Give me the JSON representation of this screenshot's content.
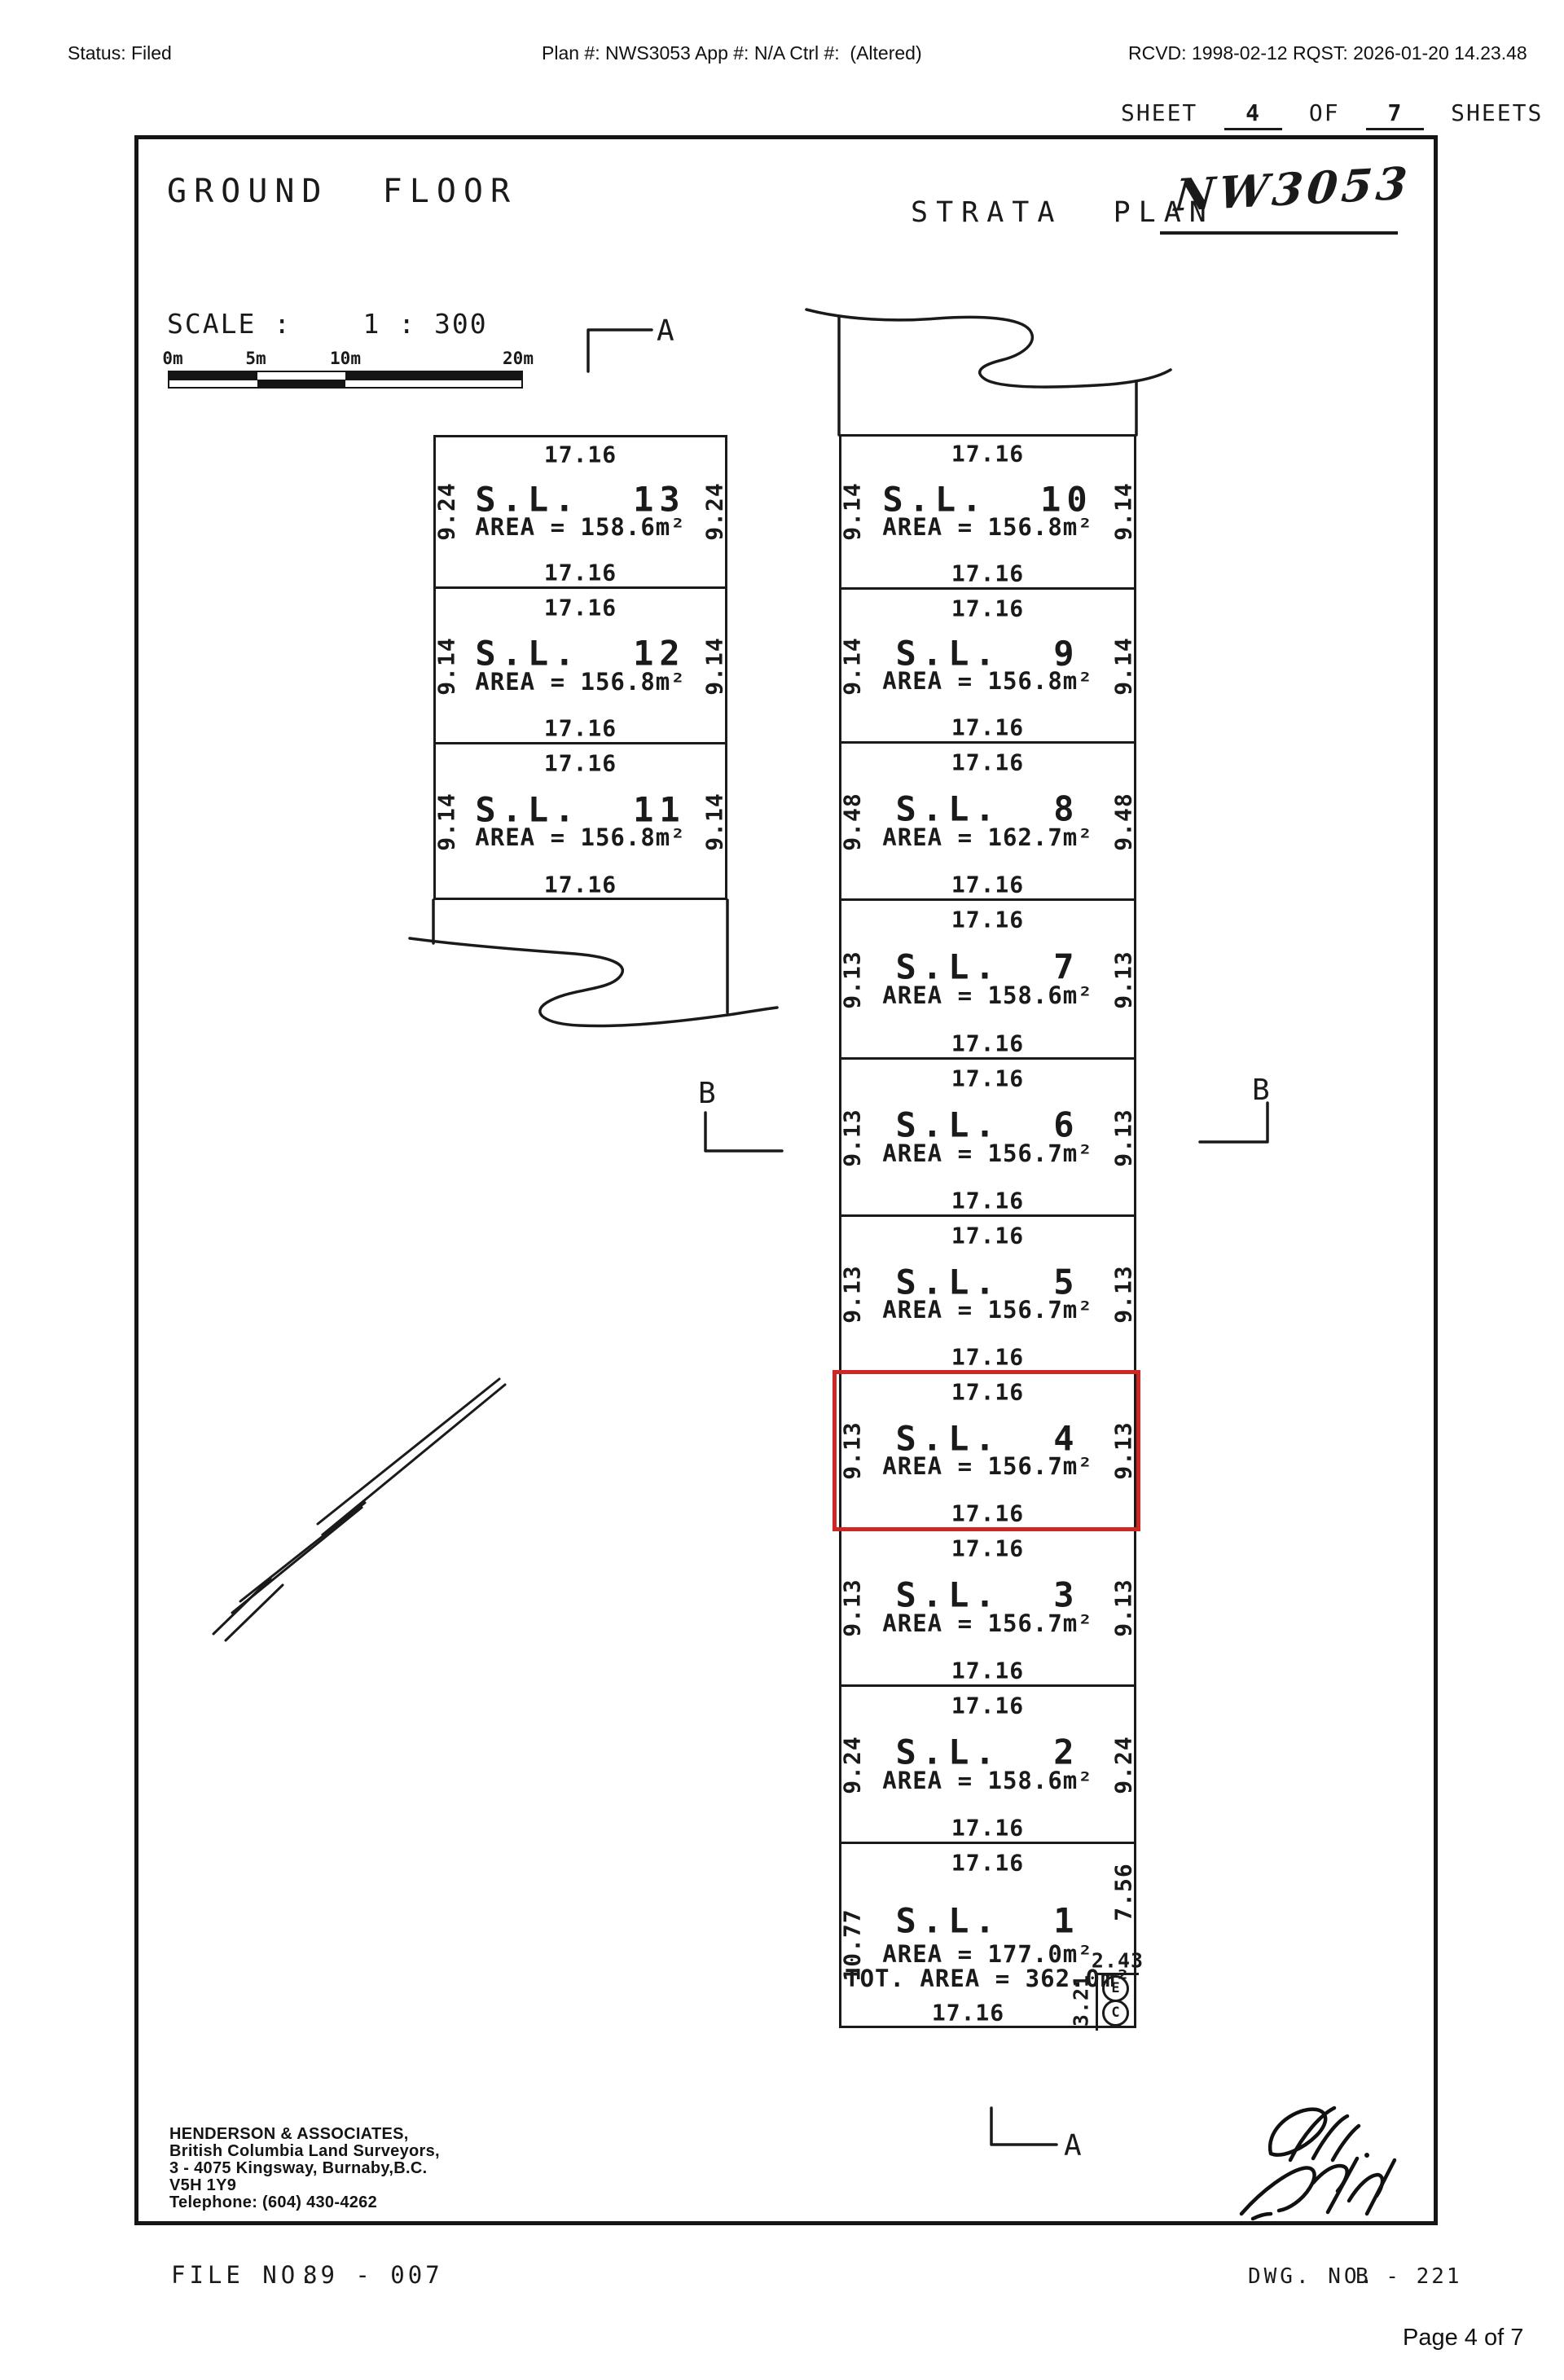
{
  "colors": {
    "ink": "#1a1a1a",
    "highlight": "#cf2723",
    "paper": "#ffffff"
  },
  "header": {
    "status": "Status: Filed",
    "plan_info": "Plan #: NWS3053 App #: N/A Ctrl #:  (Altered)",
    "received": "RCVD: 1998-02-12 RQST: 2026-01-20 14.23.48"
  },
  "sheet": {
    "label_sheet": "SHEET",
    "number": "4",
    "label_of": "OF",
    "total": "7",
    "label_sheets": "SHEETS"
  },
  "titles": {
    "floor": "GROUND  FLOOR",
    "strata_label": "STRATA  PLAN",
    "strata_number": "NW3053"
  },
  "scale": {
    "label": "SCALE :    1 : 300",
    "ticks": [
      "0m",
      "5m",
      "10m",
      "20m"
    ]
  },
  "markers": {
    "a": "A",
    "b": "B"
  },
  "lots_left": [
    {
      "id": "sl-13",
      "name": "S.L.  13",
      "area": "AREA = 158.6m²",
      "dim_top": "17.16",
      "dim_bottom": "17.16",
      "dim_left": "9.24",
      "dim_right": "9.24",
      "highlighted": false
    },
    {
      "id": "sl-12",
      "name": "S.L.  12",
      "area": "AREA = 156.8m²",
      "dim_top": "17.16",
      "dim_bottom": "17.16",
      "dim_left": "9.14",
      "dim_right": "9.14",
      "highlighted": false
    },
    {
      "id": "sl-11",
      "name": "S.L.  11",
      "area": "AREA = 156.8m²",
      "dim_top": "17.16",
      "dim_bottom": "17.16",
      "dim_left": "9.14",
      "dim_right": "9.14",
      "highlighted": false
    }
  ],
  "lots_right": [
    {
      "id": "sl-10",
      "name": "S.L.  10",
      "area": "AREA = 156.8m²",
      "dim_top": "17.16",
      "dim_bottom": "17.16",
      "dim_left": "9.14",
      "dim_right": "9.14",
      "highlighted": false
    },
    {
      "id": "sl-9",
      "name": "S.L.  9",
      "area": "AREA = 156.8m²",
      "dim_top": "17.16",
      "dim_bottom": "17.16",
      "dim_left": "9.14",
      "dim_right": "9.14",
      "highlighted": false
    },
    {
      "id": "sl-8",
      "name": "S.L.  8",
      "area": "AREA = 162.7m²",
      "dim_top": "17.16",
      "dim_bottom": "17.16",
      "dim_left": "9.48",
      "dim_right": "9.48",
      "highlighted": false
    },
    {
      "id": "sl-7",
      "name": "S.L.  7",
      "area": "AREA = 158.6m²",
      "dim_top": "17.16",
      "dim_bottom": "17.16",
      "dim_left": "9.13",
      "dim_right": "9.13",
      "highlighted": false
    },
    {
      "id": "sl-6",
      "name": "S.L.  6",
      "area": "AREA = 156.7m²",
      "dim_top": "17.16",
      "dim_bottom": "17.16",
      "dim_left": "9.13",
      "dim_right": "9.13",
      "highlighted": false
    },
    {
      "id": "sl-5",
      "name": "S.L.  5",
      "area": "AREA = 156.7m²",
      "dim_top": "17.16",
      "dim_bottom": "17.16",
      "dim_left": "9.13",
      "dim_right": "9.13",
      "highlighted": false
    },
    {
      "id": "sl-4",
      "name": "S.L.  4",
      "area": "AREA = 156.7m²",
      "dim_top": "17.16",
      "dim_bottom": "17.16",
      "dim_left": "9.13",
      "dim_right": "9.13",
      "highlighted": true
    },
    {
      "id": "sl-3",
      "name": "S.L.  3",
      "area": "AREA = 156.7m²",
      "dim_top": "17.16",
      "dim_bottom": "17.16",
      "dim_left": "9.13",
      "dim_right": "9.13",
      "highlighted": false
    },
    {
      "id": "sl-2",
      "name": "S.L.  2",
      "area": "AREA = 158.6m²",
      "dim_top": "17.16",
      "dim_bottom": "17.16",
      "dim_left": "9.24",
      "dim_right": "9.24",
      "highlighted": false
    },
    {
      "id": "sl-1",
      "name": "S.L.  1",
      "area": "AREA = 177.0m²",
      "area_total": "TOT. AREA = 362.0m²",
      "dim_top": "17.16",
      "dim_bottom": "17.16",
      "dim_left": "10.77",
      "dim_right": "7.56",
      "highlighted": false,
      "notch": {
        "top": "2.43",
        "side": "3.21",
        "badges": [
          "E",
          "C"
        ]
      }
    }
  ],
  "surveyor": {
    "lines": [
      "HENDERSON & ASSOCIATES,",
      "British Columbia Land Surveyors,",
      "3 - 4075 Kingsway, Burnaby,B.C.",
      "V5H 1Y9",
      "Telephone: (604) 430-4262"
    ]
  },
  "footer": {
    "file_label": "FILE  NO.",
    "file_value": "89 - 007",
    "dwg_label": "DWG.  NO.",
    "dwg_value": "B - 221",
    "page": "Page 4 of 7"
  }
}
